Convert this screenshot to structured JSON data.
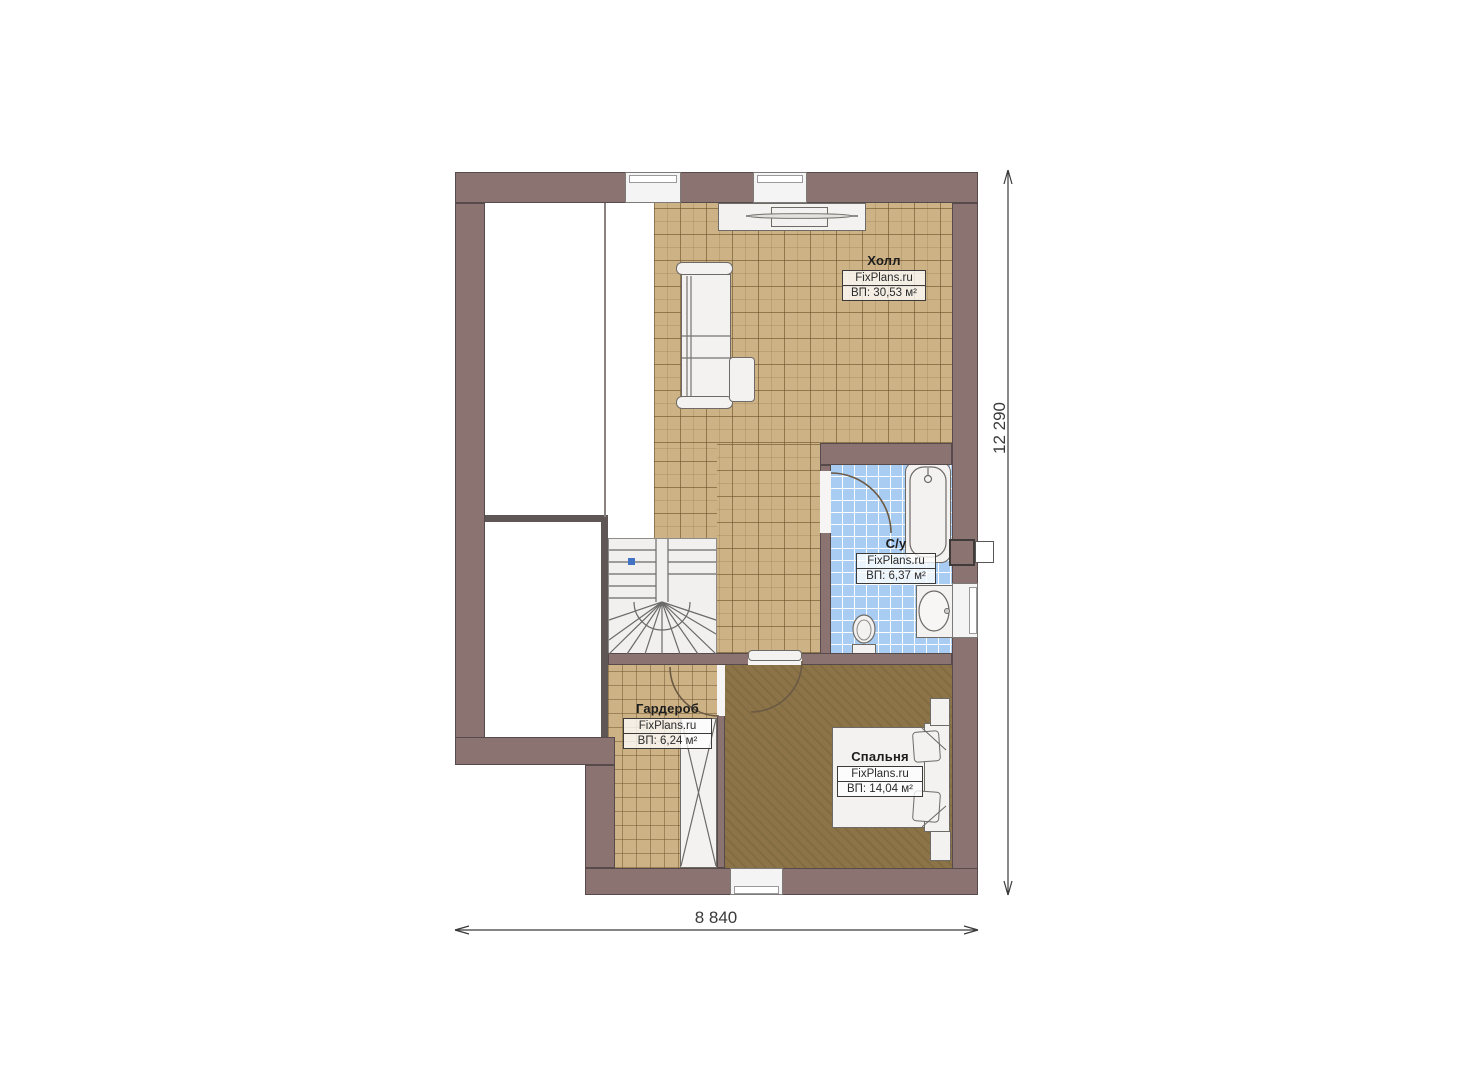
{
  "rooms": {
    "hall": {
      "title": "Холл",
      "watermark": "FixPlans.ru",
      "area": "ВП: 30,53 м²"
    },
    "bathroom": {
      "title": "С/у",
      "watermark": "FixPlans.ru",
      "area": "ВП: 6,37 м²"
    },
    "wardrobe": {
      "title": "Гардероб",
      "watermark": "FixPlans.ru",
      "area": "ВП: 6,24 м²"
    },
    "bedroom": {
      "title": "Спальня",
      "watermark": "FixPlans.ru",
      "area": "ВП: 14,04 м²"
    }
  },
  "dimensions": {
    "width_label": "8 840",
    "height_label": "12 290"
  },
  "colors": {
    "wall": "#8b7372",
    "wall_line": "#564b4a",
    "tile_beige": "#cdb286",
    "tile_blue": "#a9ccf2",
    "floor_bedroom": "#8c7448",
    "furniture": "#f3f2f0",
    "stair_marker": "#4472c4",
    "dimension_line": "#3a3a3a"
  }
}
